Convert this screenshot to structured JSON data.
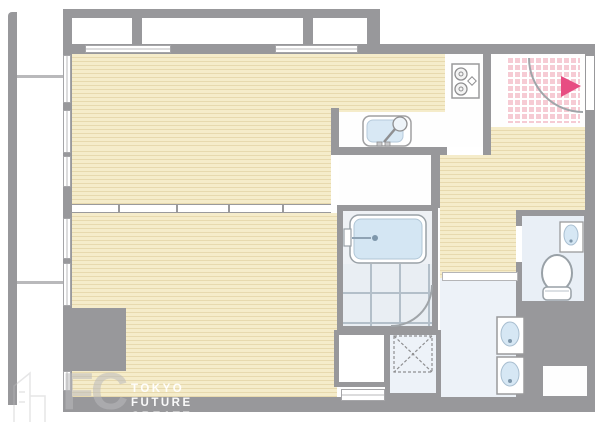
{
  "watermark": {
    "logo_initials": "FC",
    "lines": [
      "TOKYO",
      "FUTURE",
      "CREATE"
    ]
  },
  "colors": {
    "wall_gray": "#98989b",
    "wood_floor": "#f5ecca",
    "wood_floor_line": "#e7d9ae",
    "wet_area_floor": "#edf2f8",
    "bath_tile_line": "#b3bfc9",
    "entrance_tile_pink": "#f6cbd4",
    "fixture_blue": "#d4e6f3",
    "entrance_arrow_pink": "#e74d82",
    "watermark_gray": "#b9b9bc",
    "watermark_white": "#ffffff"
  },
  "icons": {
    "gas-stove-icon": "two burner circles in square",
    "kitchen-sink-icon": "rounded basin with round faucet",
    "bathtub-icon": "rounded tub with faucet tab",
    "bath-door-icon": "quarter arc swing",
    "washing-machine-place-icon": "dashed square with X",
    "vanity-sink-icon": "oval basin in square",
    "toilet-icon": "bowl ellipse with seat block",
    "hand-basin-icon": "small oval sink in square",
    "entrance-door-icon": "quarter arc swing",
    "entrance-direction-icon": "solid pink triangle pointing right"
  }
}
